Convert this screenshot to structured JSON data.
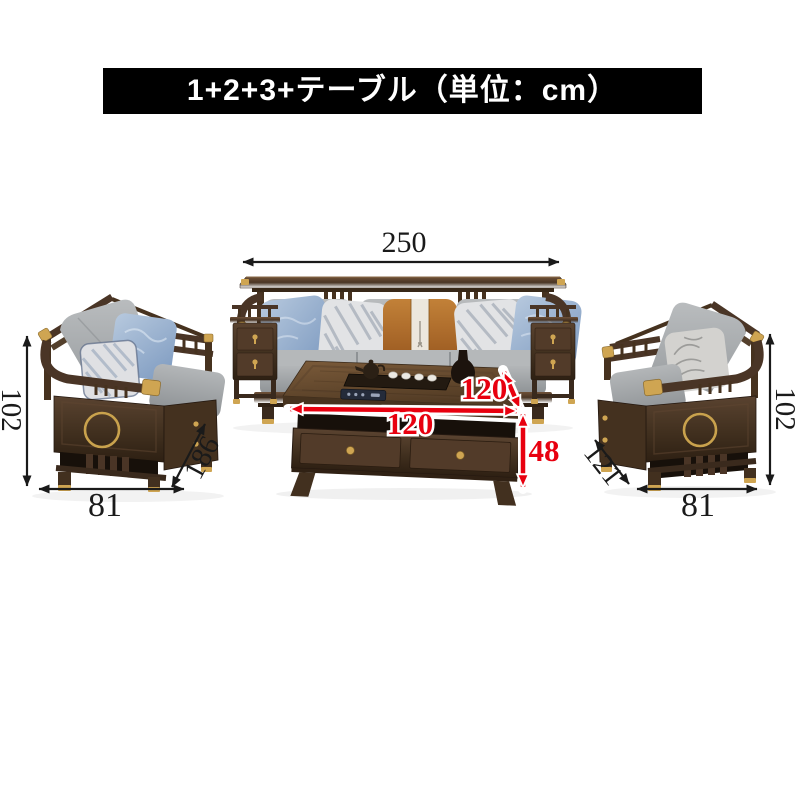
{
  "banner": {
    "title": "1+2+3+テーブル（単位：cm）",
    "bg_color": "#000000",
    "text_color": "#ffffff"
  },
  "dims": {
    "sofa3_width": "250",
    "sofa2_height": "102",
    "sofa2_depth": "186",
    "sofa2_width": "81",
    "sofa1_height": "102",
    "sofa1_depth": "121",
    "sofa1_width": "81",
    "table_depth": "120",
    "table_width": "120",
    "table_height": "48"
  },
  "colors": {
    "dimension_black": "#1a1a1a",
    "dimension_red": "#e8000f",
    "dimension_red_outline": "#ffffff",
    "wood_dark": "#41301f",
    "wood_light": "#6e5138",
    "gold_accent": "#cfa552",
    "cushion_gray": "#a7abae",
    "pillow_blue": "#8fa9c9",
    "pillow_orange": "#b06c2c",
    "background": "#ffffff"
  },
  "furniture": {
    "three_seater_label": "3-seater sofa",
    "two_seater_label": "2-seater sofa",
    "single_seater_label": "1-seater sofa",
    "table_label": "coffee table"
  }
}
